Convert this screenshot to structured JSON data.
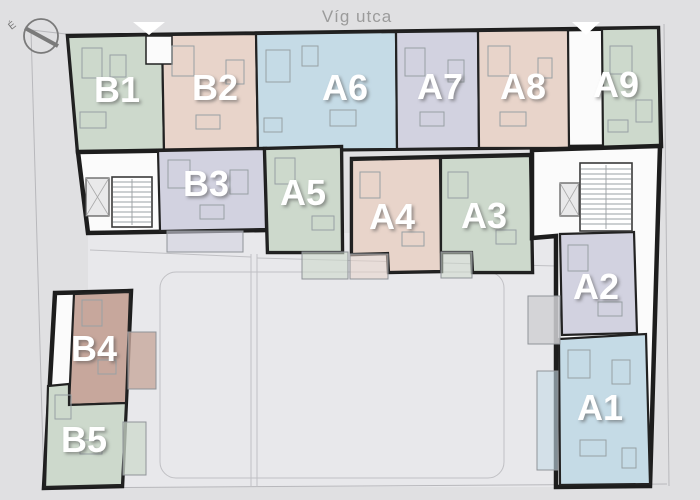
{
  "plan": {
    "street_label": "Víg utca",
    "compass_label": "É"
  },
  "icons": {
    "compass": "north-arrow-icon",
    "entrance": "entrance-triangle-icon"
  },
  "palette": {
    "background": "#e0e0e2",
    "courtyard": "#e8e8eb",
    "wall": "#1d1d1d",
    "street_text": "#9b9b9b",
    "terrace_gray": "#d0d0d3"
  },
  "units": [
    {
      "label": "A1",
      "color": "#c5dbe6"
    },
    {
      "label": "A2",
      "color": "#d2d2e0"
    },
    {
      "label": "A3",
      "color": "#cdd9cc"
    },
    {
      "label": "A4",
      "color": "#e8d4ca"
    },
    {
      "label": "A5",
      "color": "#cdd9cc"
    },
    {
      "label": "A6",
      "color": "#c5dbe6"
    },
    {
      "label": "A7",
      "color": "#d2d2e0"
    },
    {
      "label": "A8",
      "color": "#e8d4ca"
    },
    {
      "label": "A9",
      "color": "#cdd9cc"
    },
    {
      "label": "B1",
      "color": "#cdd9cc"
    },
    {
      "label": "B2",
      "color": "#e8d4ca"
    },
    {
      "label": "B3",
      "color": "#d2d2e0"
    },
    {
      "label": "B4",
      "color": "#c7a79c"
    },
    {
      "label": "B5",
      "color": "#cdd9cc"
    }
  ]
}
